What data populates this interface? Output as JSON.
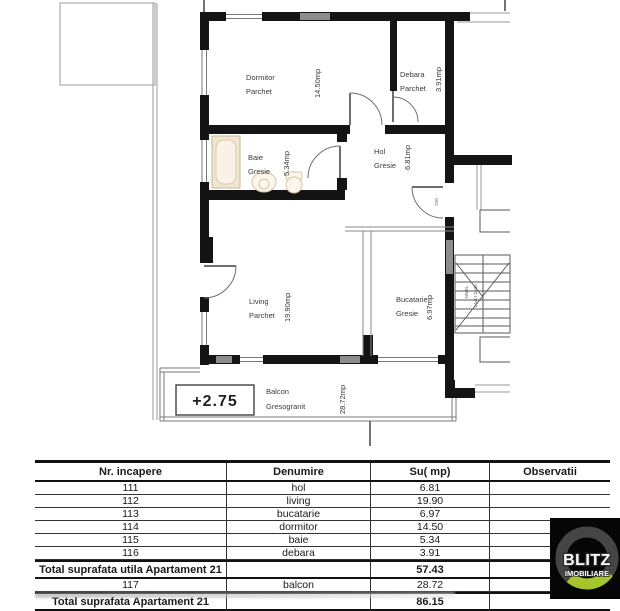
{
  "plan": {
    "rooms": [
      {
        "name": "Dormitor",
        "finish": "Parchet",
        "area": "14.50mp"
      },
      {
        "name": "Debara",
        "finish": "Parchet",
        "area": "3.91mp"
      },
      {
        "name": "Baie",
        "finish": "Gresie",
        "area": "5.34mp"
      },
      {
        "name": "Hol",
        "finish": "Gresie",
        "area": "6.81mp"
      },
      {
        "name": "Living",
        "finish": "Parchet",
        "area": "19.90mp"
      },
      {
        "name": "Bucatarie",
        "finish": "Gresie",
        "area": "6.97mp"
      },
      {
        "name": "Balcon",
        "finish": "Gresogranit",
        "area": "28.72mp"
      }
    ],
    "elevation_label": "+2.75",
    "door_width_label": "210",
    "stair_labels": [
      "NIVEL",
      "14x17,5x30"
    ]
  },
  "table": {
    "headers": [
      "Nr. incapere",
      "Denumire",
      "Su( mp)",
      "Observatii"
    ],
    "rows": [
      [
        "111",
        "hol",
        "6.81",
        ""
      ],
      [
        "112",
        "living",
        "19.90",
        ""
      ],
      [
        "113",
        "bucatarie",
        "6.97",
        ""
      ],
      [
        "114",
        "dormitor",
        "14.50",
        ""
      ],
      [
        "115",
        "baie",
        "5.34",
        ""
      ],
      [
        "116",
        "debara",
        "3.91",
        ""
      ],
      [
        "Total suprafata utila Apartament 21",
        "",
        "57.43",
        ""
      ],
      [
        "117",
        "balcon",
        "28.72",
        ""
      ],
      [
        "Total suprafata Apartament 21",
        "",
        "86.15",
        ""
      ]
    ]
  },
  "logo": {
    "line1": "BLITZ",
    "line2": "IMOBILIARE",
    "colors": {
      "ring": "#454545",
      "accent": "#a4c62c",
      "background": "#060606",
      "text": "#ffffff"
    }
  }
}
